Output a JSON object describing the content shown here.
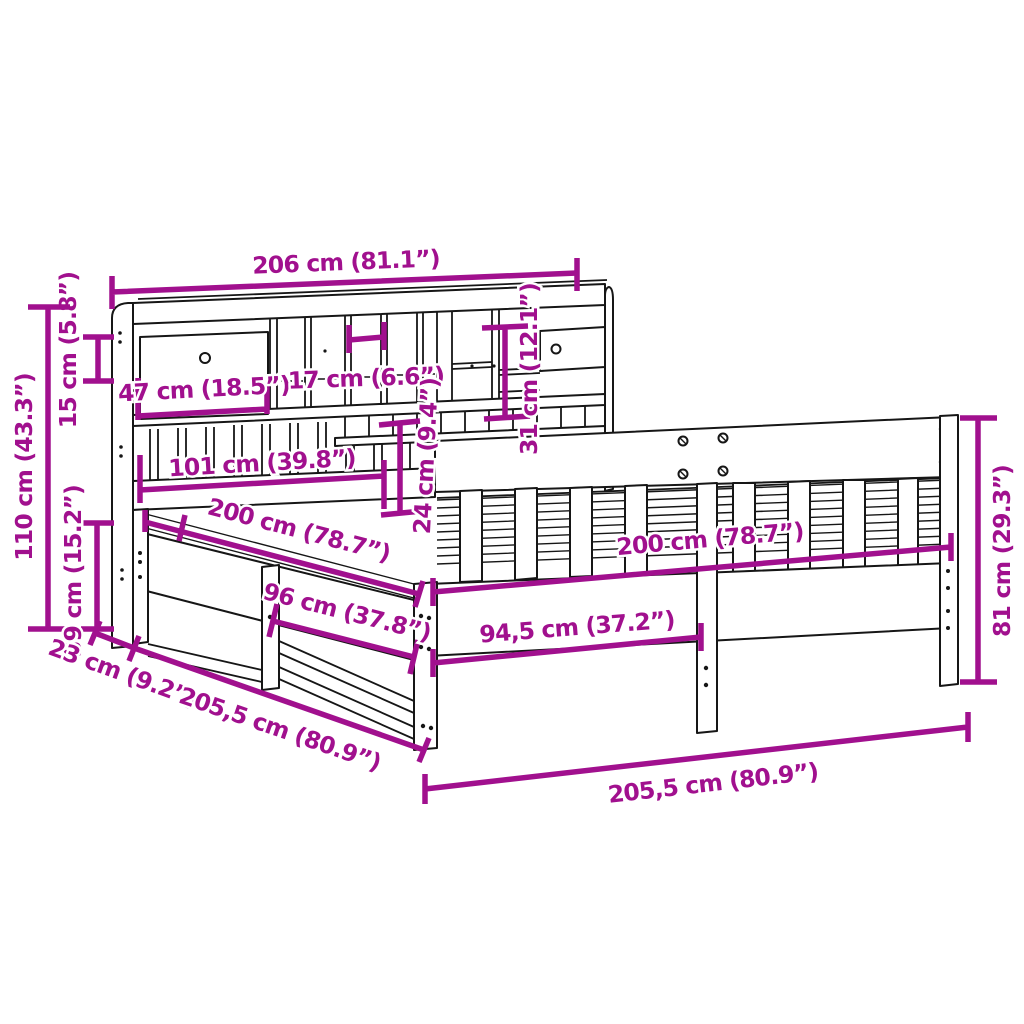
{
  "diagram": {
    "kind": "product-dimension-diagram",
    "subject": "bookcase-bed-frame",
    "background_color": "#ffffff",
    "art_color": "#161616",
    "dimension_color": "#a1108e",
    "dimensions": {
      "headboard_width": "206 cm (81.1”)",
      "drawer_compartment_width": "47 cm (18.5”)",
      "cubby_width": "17 cm (6.6”)",
      "shelf_compartment_height": "31 cm (12.1”)",
      "top_shelf_height": "15 cm (5.8”)",
      "headboard_height": "110 cm (43.3”)",
      "headboard_lower_height": "39 cm (15.2”)",
      "slat_panel_width": "101 cm (39.8”)",
      "bed_length_left": "200 cm (78.7”)",
      "slat_panel_height": "24 cm (9.4”)",
      "front_section_width_left": "96 cm (37.8”)",
      "bed_length_right": "200 cm (78.7”)",
      "front_section_width_right": "94,5 cm (37.2”)",
      "side_rail_height": "81 cm (29.3”)",
      "headboard_depth": "23 cm (9.2”)",
      "overall_length_side": "205,5 cm (80.9”)",
      "overall_length_front": "205,5 cm (80.9”)"
    }
  }
}
